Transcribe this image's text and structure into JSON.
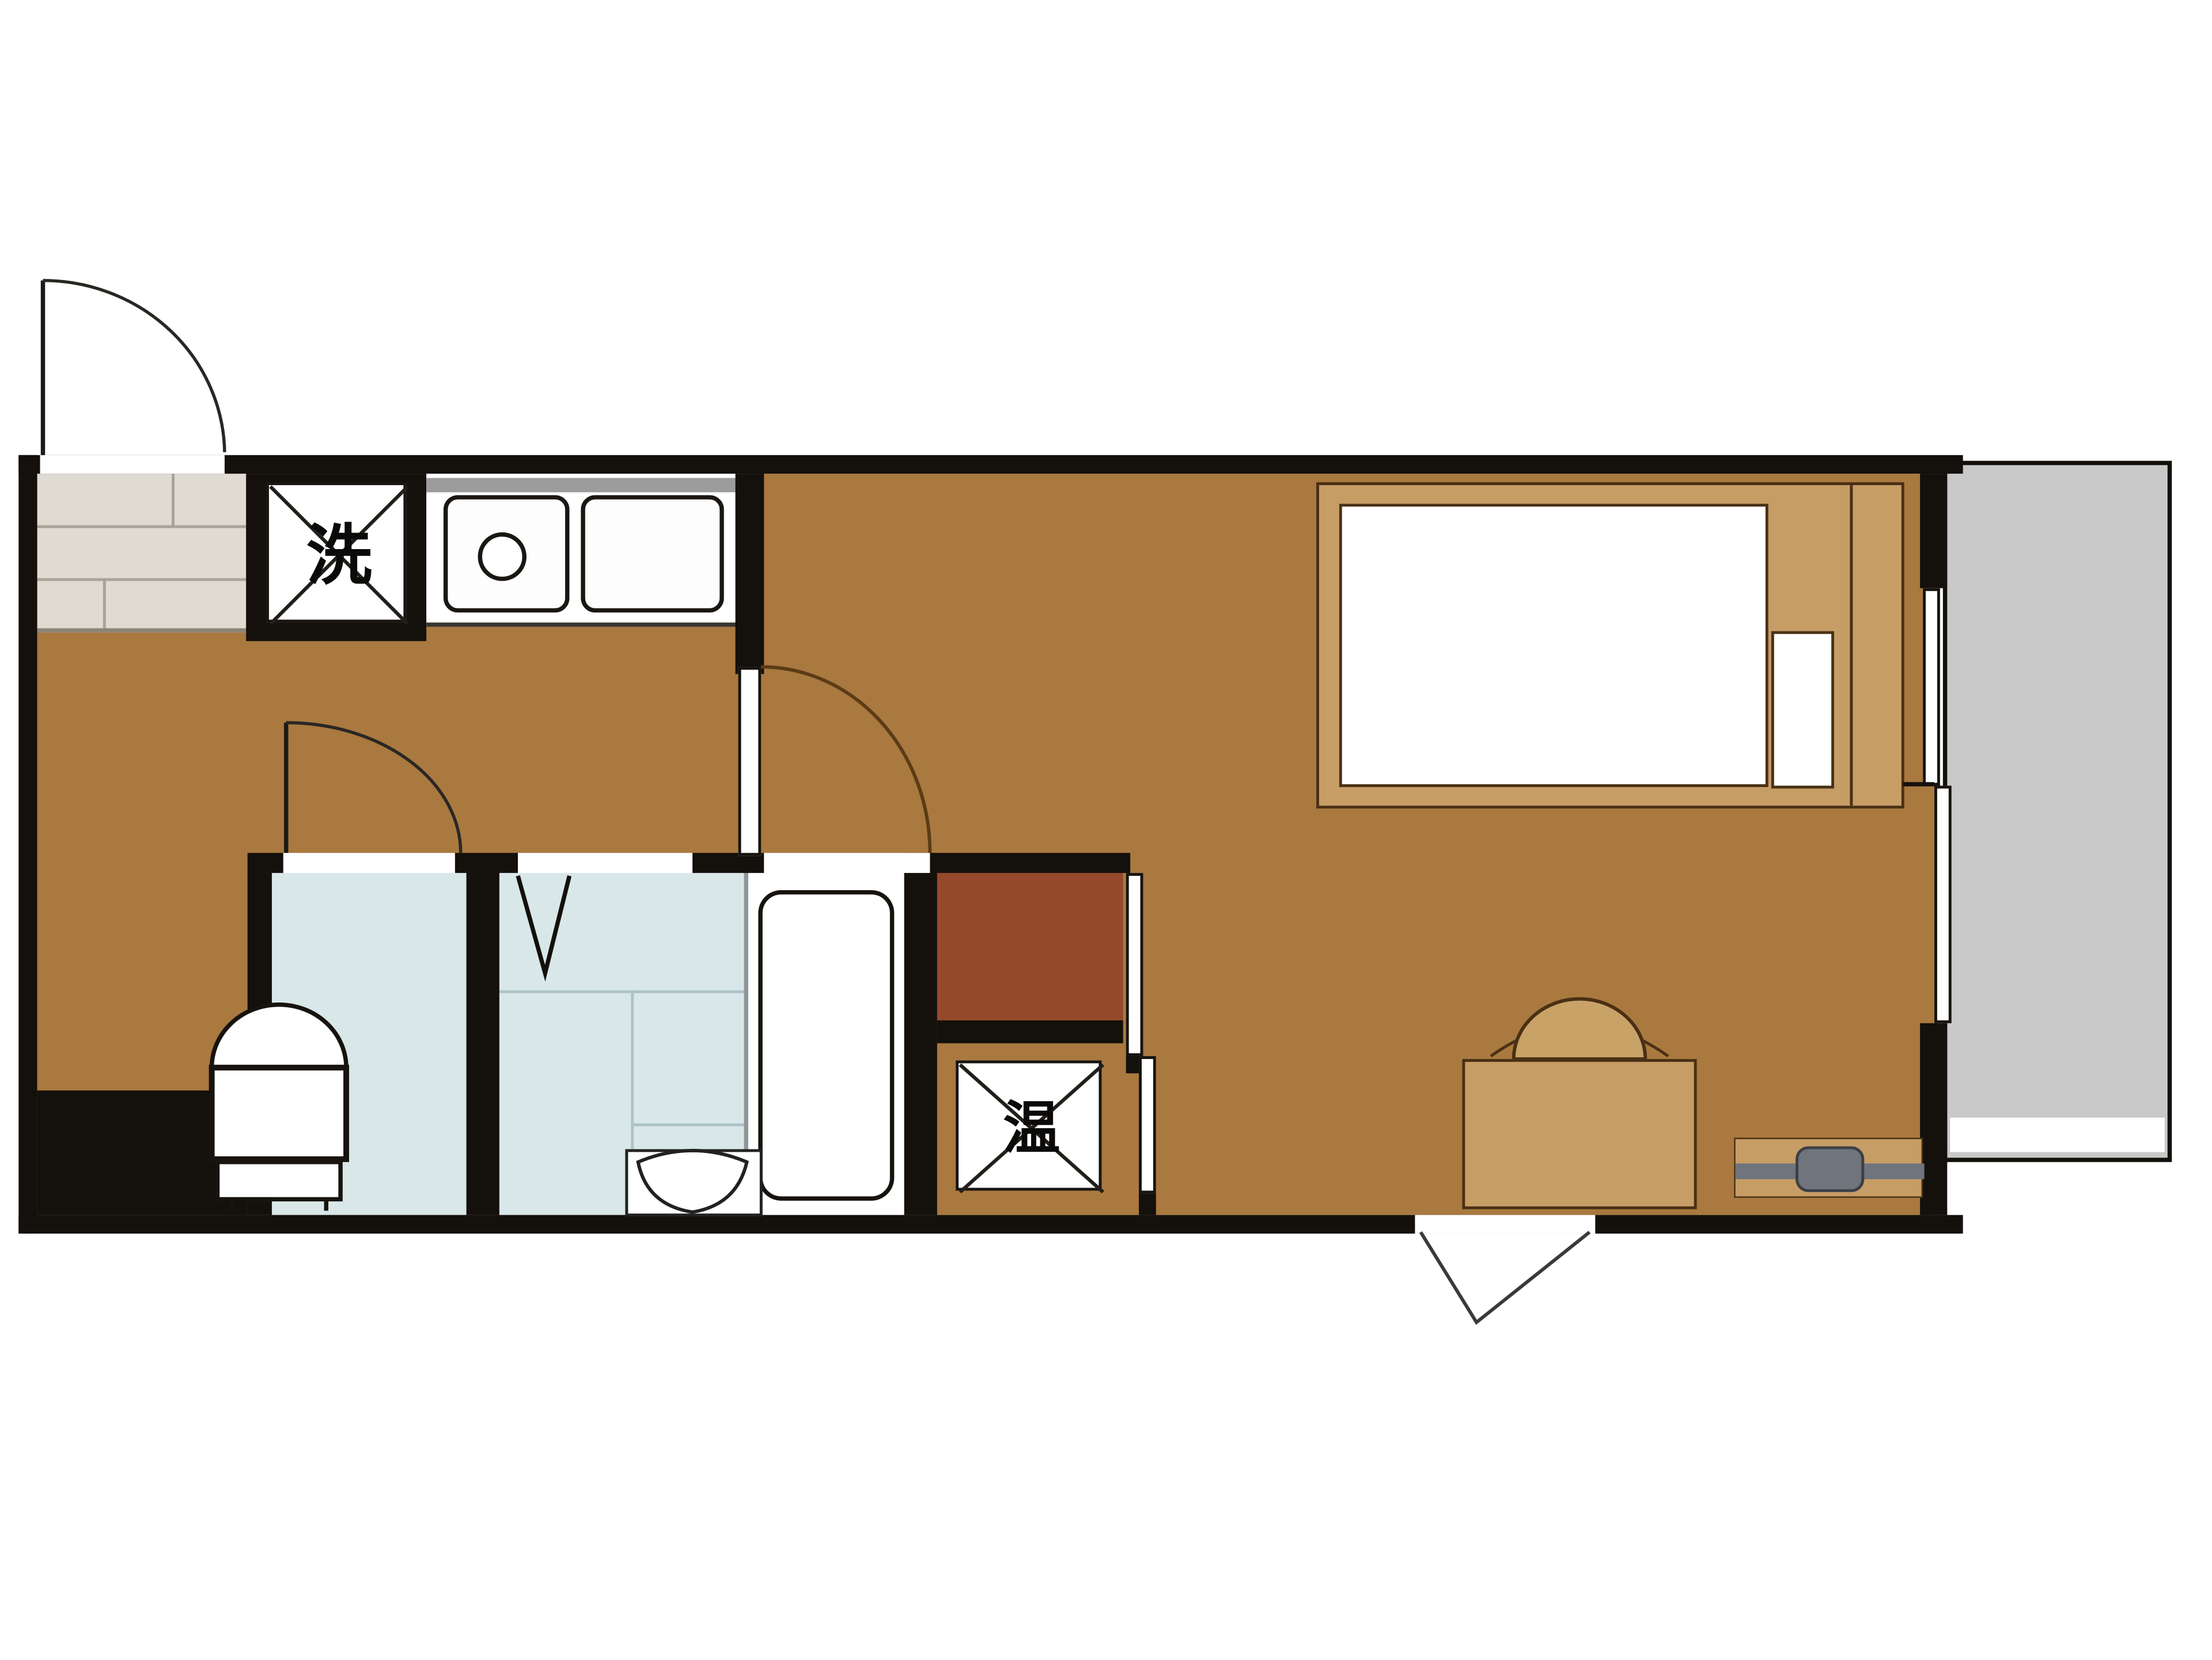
{
  "floorplan": {
    "kind": "japanese-apartment-floor-plan",
    "labels": {
      "washing_machine": "洗",
      "water_heater": "温"
    },
    "colors": {
      "wall": "#14100b",
      "wood_floor": "#a9793f",
      "entrance_tile": "#dfdbd2",
      "wet_area_floor": "#d9e7e9",
      "closet": "#96492a",
      "balcony": "#c9c9c9",
      "furniture_wood": "#c79d66",
      "tv_gray": "#6f747d",
      "fixture_white": "#ffffff"
    }
  }
}
